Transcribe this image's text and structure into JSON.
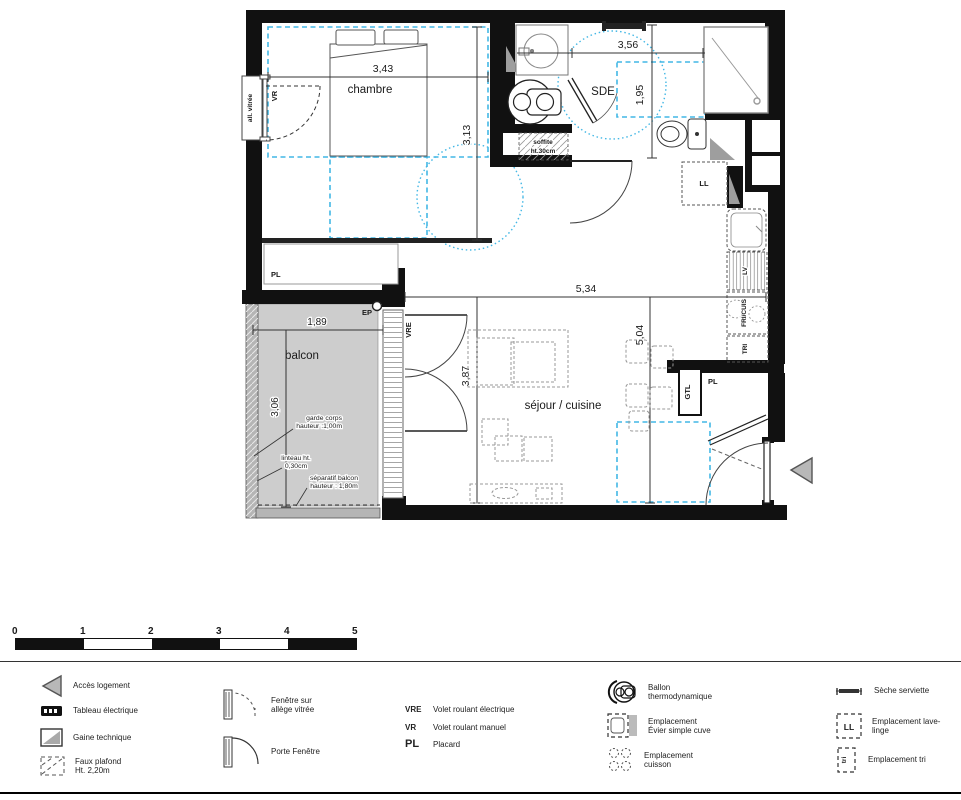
{
  "plan": {
    "chambre": {
      "name": "chambre",
      "width": "3,43",
      "height": "3,13"
    },
    "sde": {
      "name": "SDE",
      "width": "3,56",
      "height": "1,95"
    },
    "sejour": {
      "name": "séjour / cuisine",
      "width": "5,34",
      "height": "5,04",
      "height2": "3,87"
    },
    "balcon": {
      "name": "balcon",
      "width": "1,89",
      "height": "3,06",
      "garde_corps_1": "garde corps",
      "garde_corps_2": "hauteur :1,00m",
      "linteau_1": "linteau ht.",
      "linteau_2": "0,30cm",
      "separatif_1": "séparatif balcon",
      "separatif_2": "hauteur : 1,80m"
    },
    "tags": {
      "all_vitree": "all. vitrée",
      "vr": "VR",
      "vre": "VRE",
      "pl_chambre": "PL",
      "pl_entree": "PL",
      "ep": "EP",
      "ll": "LL",
      "lv": "LV",
      "fri_cuis": "FRI/CUIS",
      "tri": "TRI",
      "gtl": "GTL",
      "soffite_1": "soffite",
      "soffite_2": "ht.30cm"
    }
  },
  "scale_bar": {
    "ticks": [
      "0",
      "1",
      "2",
      "3",
      "4",
      "5"
    ]
  },
  "legend": {
    "acces": "Accès logement",
    "tableau": "Tableau électrique",
    "gaine": "Gaine technique",
    "faux_plafond_1": "Faux plafond",
    "faux_plafond_2": "Ht. 2,20m",
    "fenetre_1": "Fenêtre sur",
    "fenetre_2": "allège vitrée",
    "porte_fenetre": "Porte Fenêtre",
    "vre_abbr": "VRE",
    "vre_def": "Volet roulant électrique",
    "vr_abbr": "VR",
    "vr_def": "Volet roulant manuel",
    "pl_abbr": "PL",
    "pl_def": "Placard",
    "ballon_1": "Ballon",
    "ballon_2": "thermodynamique",
    "evier_1": "Emplacement",
    "evier_2": "Évier simple cuve",
    "cuisson_1": "Emplacement",
    "cuisson_2": "cuisson",
    "seche": "Sèche serviette",
    "lave_linge_1": "Emplacement lave-",
    "lave_linge_2": "linge",
    "tri": "Emplacement tri",
    "ll_tag": "LL",
    "tri_tag": "tri"
  },
  "colors": {
    "wall": "#111111",
    "faux_plafond_blue": "#42b7e5",
    "balcony_gray": "#cdcdcd",
    "railing_gray": "#b5b5b5",
    "accent_gray": "#b8b8b8"
  }
}
